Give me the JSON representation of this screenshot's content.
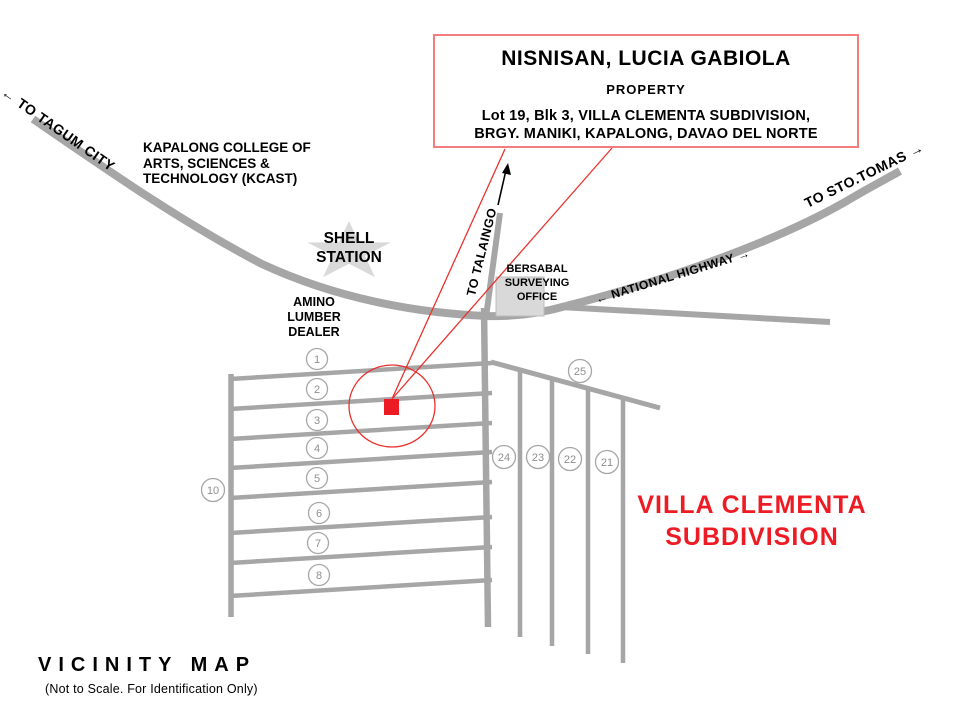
{
  "title_box": {
    "owner": "NISNISAN, LUCIA GABIOLA",
    "label": "PROPERTY",
    "address_line1": "Lot 19, Blk 3, VILLA CLEMENTA SUBDIVISION,",
    "address_line2": "BRGY. MANIKI, KAPALONG, DAVAO DEL NORTE"
  },
  "roads": {
    "to_tagum": "← TO TAGUM CITY",
    "to_sto_tomas": "TO STO.TOMAS →",
    "national_highway": "← NATIONAL HIGHWAY →",
    "to_talaingo": "TO TALAINGO"
  },
  "landmarks": {
    "kcast_line1": "KAPALONG COLLEGE OF",
    "kcast_line2": "ARTS, SCIENCES &",
    "kcast_line3": "TECHNOLOGY (KCAST)",
    "shell_line1": "SHELL",
    "shell_line2": "STATION",
    "amino_line1": "AMINO",
    "amino_line2": "LUMBER",
    "amino_line3": "DEALER",
    "bersabal_line1": "BERSABAL",
    "bersabal_line2": "SURVEYING",
    "bersabal_line3": "OFFICE"
  },
  "subdivision": {
    "name_line1": "VILLA CLEMENTA",
    "name_line2": "SUBDIVISION",
    "lots_left": [
      "1",
      "2",
      "3",
      "4",
      "5",
      "6",
      "7",
      "8"
    ],
    "lot_west": "10",
    "lot_northeast": "25",
    "lots_right": [
      "24",
      "23",
      "22",
      "21"
    ]
  },
  "footer": {
    "map_title": "VICINITY MAP",
    "map_note": "(Not to Scale. For Identification Only)"
  },
  "colors": {
    "road_gray": "#a6a6a6",
    "landmark_gray": "#d9d9d9",
    "leader_red": "#e8332e",
    "marker_red": "#ed1c24",
    "box_border_red": "#f37d7d"
  }
}
